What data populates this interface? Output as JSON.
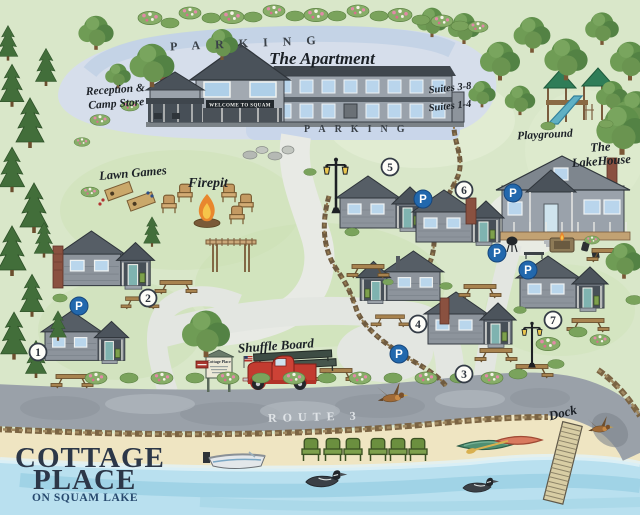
{
  "branding": {
    "title_line1": "COTTAGE",
    "title_line2": "PLACE",
    "subtitle": "ON SQUAM LAKE"
  },
  "labels": {
    "parking_top": "PARKING",
    "parking_lower": "PARKING",
    "apartment": "The Apartment",
    "welcome_sign": "WELCOME TO SQUAM",
    "reception_line1": "Reception &",
    "reception_line2": "Camp Store",
    "suites_upper": "Suites 3-8",
    "suites_lower": "Suites 1-4",
    "playground": "Playground",
    "lakehouse_line1": "The",
    "lakehouse_line2": "LakeHouse",
    "lawn_games": "Lawn Games",
    "firepit": "Firepit",
    "shuffle_board": "Shuffle Board",
    "route": "ROUTE 3",
    "dock": "Dock",
    "entrance_sign": "Cottage Place"
  },
  "cottages": [
    {
      "number": "1"
    },
    {
      "number": "2"
    },
    {
      "number": "3"
    },
    {
      "number": "4"
    },
    {
      "number": "5"
    },
    {
      "number": "6"
    },
    {
      "number": "7"
    }
  ],
  "parking_badge_letter": "P",
  "colors": {
    "parking_badge": "#2268ad",
    "logo_title": "#2c3748",
    "logo_subtitle": "#27496e",
    "water": "#b9e0ef",
    "grass": "#d9e7c9",
    "road": "#9aa1a9",
    "sand": "#efe5c2"
  }
}
